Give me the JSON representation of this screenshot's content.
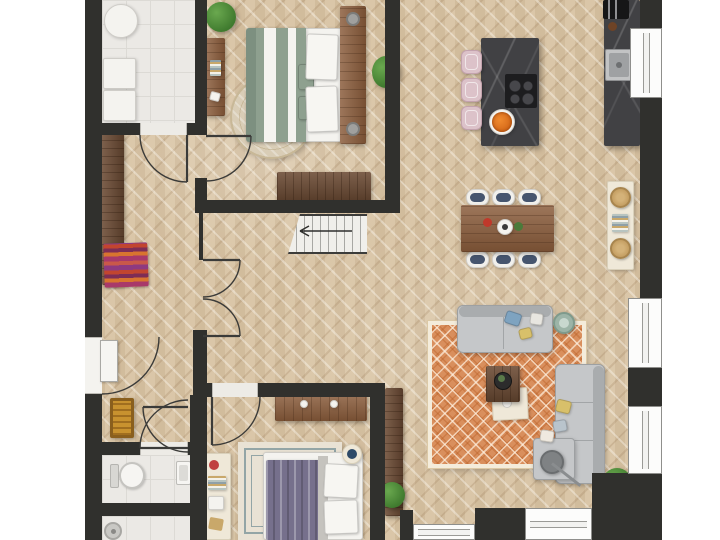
{
  "meta": {
    "view": "top-down-floor-plan",
    "floor_shown": "ground floor",
    "style": "rendered color floor plan, no text labels"
  },
  "palette": {
    "wall": "#30302d",
    "wood_floor": "#d8c3a3",
    "tile": "#ebe9e5",
    "oak": "#8a5c3b",
    "walnut": "#6b4a33",
    "marble": "#414144",
    "cream": "#efe8d8",
    "sofa": "#c5c7c9",
    "rug_terracotta": "#d98f5d",
    "rug_border": "#f4ecdb",
    "sage": "#8ea08f",
    "purple": "#76708c",
    "stool_pink": "#dcc2c9",
    "navy": "#46556e",
    "orange": "#e2701c",
    "plant_green": "#3f7a2e",
    "doormat": "#c8922f",
    "white": "#f5f4f0"
  },
  "labels": {
    "laundry": "Laundry room",
    "hallway": "Entrance hall",
    "vestibule": "Rear hall",
    "bedroom1": "Bedroom",
    "kitchen": "Kitchen",
    "dining": "Dining area",
    "living": "Living room",
    "bedroom2": "Bedroom",
    "wc": "Toilet",
    "shower": "Shower room",
    "washer": "Washing machine",
    "dryer": "Dryer",
    "laundry_table": "Round side table",
    "coat_rack": "Coat rack",
    "shoe_shelf": "Shoe shelf",
    "doormat": "Doormat",
    "front_door": "Front door",
    "stairs": "Staircase down",
    "bed1": "Double bed with sage bedding",
    "rug1": "Round patterned rug",
    "desk1": "Dresser",
    "headboard": "Headboard with nightstands",
    "wardrobe1": "Wardrobe",
    "island": "Kitchen island",
    "cooktop": "Induction cooktop",
    "stool": "Bar stool",
    "fruit": "Fruit bowl",
    "counter": "Kitchen counter",
    "sink": "Sink",
    "espresso": "Espresso machine",
    "table": "Dining table",
    "chair": "Dining chair",
    "sideboard": "Sideboard",
    "rug_living": "Terracotta patterned rug",
    "sofa": "Sofa",
    "sectional": "Corner sofa",
    "coffee_table": "Coffee table",
    "ottoman": "Ottoman",
    "side_table": "Side table",
    "floor_lamp": "Floor lamp",
    "plant": "Plant",
    "dresser2": "Dresser",
    "bed2": "Bed with purple throw",
    "rug2": "Bordered rug",
    "desk2": "Shelf with accessories",
    "console": "Console shelf",
    "nightstand": "Nightstand",
    "toilet": "Toilet",
    "washbasin": "Washbasin",
    "shower_head": "Shower",
    "window": "Window",
    "door": "Door swing"
  },
  "rooms": [
    {
      "id": "laundry",
      "floor": "tile",
      "furniture": [
        "laundry_table",
        "washer",
        "dryer"
      ]
    },
    {
      "id": "hallway",
      "floor": "herringbone",
      "furniture": [
        "coat_rack",
        "shoe_shelf",
        "front_door",
        "doormat"
      ]
    },
    {
      "id": "bedroom1",
      "floor": "herringbone",
      "furniture": [
        "bed1",
        "rug1",
        "desk1",
        "headboard",
        "wardrobe1",
        "plant"
      ]
    },
    {
      "id": "kitchen",
      "floor": "herringbone",
      "furniture": [
        "island",
        "cooktop",
        "stool",
        "fruit",
        "counter",
        "sink",
        "espresso"
      ]
    },
    {
      "id": "dining",
      "floor": "herringbone",
      "furniture": [
        "table",
        "chair",
        "sideboard"
      ]
    },
    {
      "id": "living",
      "floor": "herringbone",
      "furniture": [
        "rug_living",
        "sofa",
        "sectional",
        "coffee_table",
        "ottoman",
        "side_table",
        "floor_lamp",
        "plant",
        "console"
      ]
    },
    {
      "id": "bedroom2",
      "floor": "herringbone",
      "furniture": [
        "bed2",
        "rug2",
        "dresser2",
        "desk2",
        "nightstand"
      ]
    },
    {
      "id": "wc",
      "floor": "tile",
      "furniture": [
        "toilet",
        "washbasin"
      ]
    },
    {
      "id": "shower",
      "floor": "tile",
      "furniture": [
        "shower_head"
      ]
    },
    {
      "id": "stairwell",
      "floor": "herringbone",
      "furniture": [
        "stairs"
      ]
    }
  ],
  "counts": {
    "dining_chairs": 6,
    "bar_stools": 3,
    "right_wall_windows": 3,
    "bottom_wall_windows": 2,
    "door_swings": 8
  }
}
